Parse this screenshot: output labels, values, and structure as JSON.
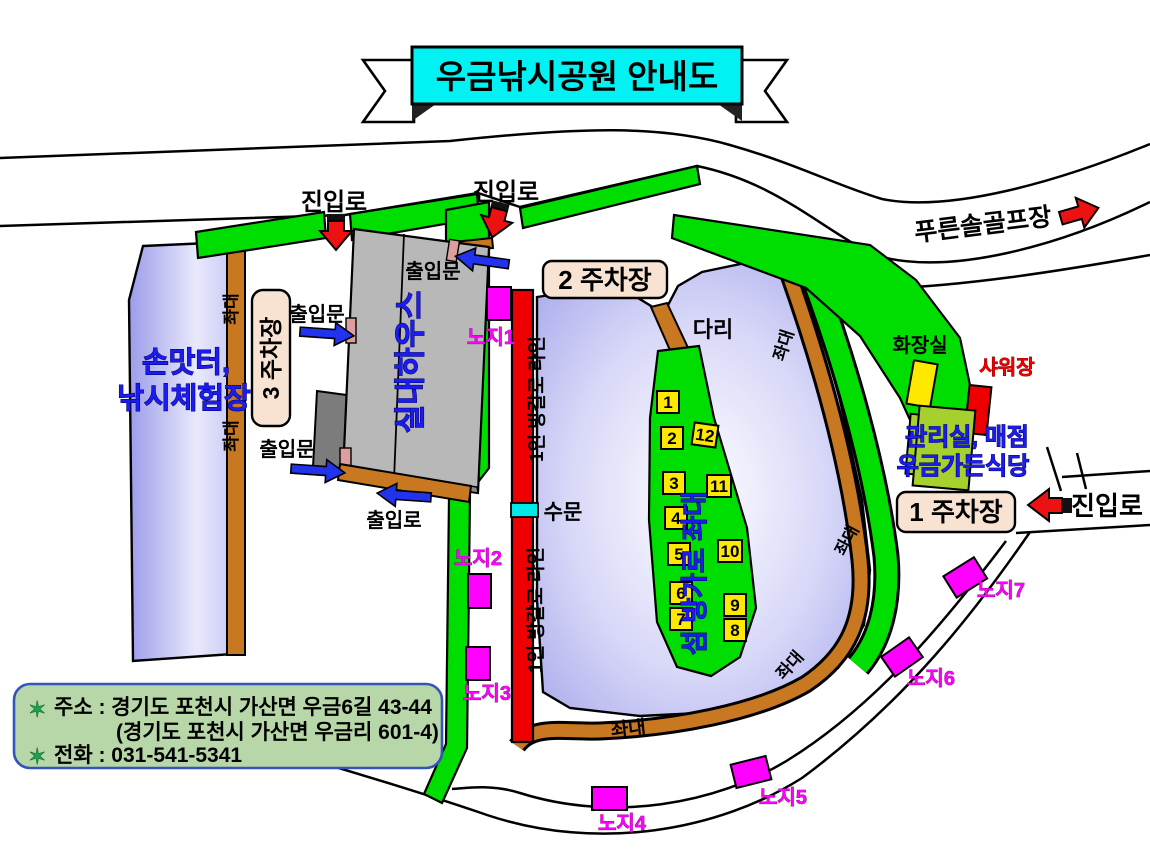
{
  "banner": {
    "title": "우금낚시공원 안내도"
  },
  "road_labels": {
    "approach": "진입로",
    "golf": "푸른솔골프장"
  },
  "gates": {
    "door": "출입문",
    "exit": "출입로"
  },
  "parking": {
    "p1": "1 주차장",
    "p2": "2 주차장",
    "p3": "3 주차장"
  },
  "left_pond": {
    "line1": "손맛터,",
    "line2": "낚시체험장"
  },
  "building": {
    "indoor_house": "실내하우스"
  },
  "platforms": {
    "jwadae": "좌대",
    "island": "섬 방가로 좌대",
    "bungalow_line": "1인 방갈로 라인"
  },
  "pond": {
    "bridge": "다리",
    "sluice": "수문"
  },
  "island_numbers": [
    "1",
    "2",
    "3",
    "4",
    "5",
    "6",
    "7",
    "8",
    "9",
    "10",
    "11",
    "12"
  ],
  "noji": {
    "n1": "노지1",
    "n2": "노지2",
    "n3": "노지3",
    "n4": "노지4",
    "n5": "노지5",
    "n6": "노지6",
    "n7": "노지7"
  },
  "facilities": {
    "toilet": "화장실",
    "shower": "샤워장",
    "office": "관리실, 매점",
    "restaurant": "우금가든식당"
  },
  "info": {
    "star": "✶",
    "address1": "주소 : 경기도 포천시 가산면 우금6길 43-44",
    "address2": "(경기도 포천시 가산면 우금리 601-4)",
    "phone": "전화 : 031-541-5341"
  },
  "colors": {
    "title_bg": "#00f2f2",
    "water": "#a8a8ec",
    "grass": "#00dd00",
    "platform_wood": "#c87820",
    "noji_marker": "#ff00ff",
    "bungalow_strip": "#ee0000",
    "sluice_marker": "#00e8e8",
    "info_bg": "#b7d7a8",
    "office_building": "#a6d02e",
    "accent_blue": "#1c1cee"
  }
}
